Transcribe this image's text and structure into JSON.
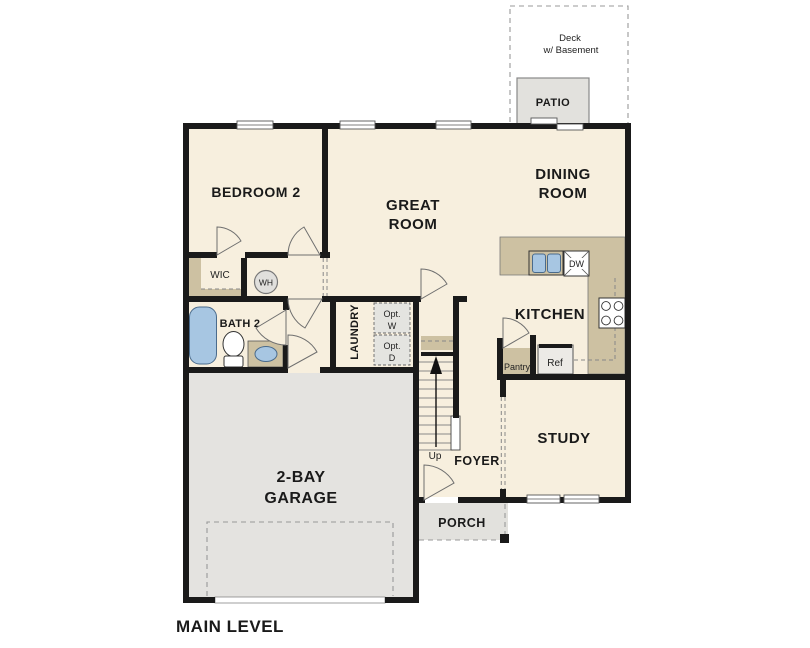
{
  "title": "MAIN LEVEL",
  "colors": {
    "floor_cream": "#f7efde",
    "wall_black": "#1a1a1a",
    "counter_tan": "#cdc1a2",
    "garage_gray": "#e4e3e0",
    "patio_gray": "#e2e1dd",
    "fixture_blue": "#a7c6e2",
    "dash_gray": "#999999"
  },
  "outdoor": {
    "deck": [
      "Deck",
      "w/ Basement"
    ],
    "patio": "PATIO",
    "porch": "PORCH"
  },
  "rooms": {
    "bedroom2": "BEDROOM 2",
    "great_room": [
      "GREAT",
      "ROOM"
    ],
    "dining_room": [
      "DINING",
      "ROOM"
    ],
    "kitchen": "KITCHEN",
    "study": "STUDY",
    "bath2": "BATH 2",
    "wic": "WIC",
    "laundry": "LAUNDRY",
    "foyer": "FOYER",
    "garage": [
      "2-BAY",
      "GARAGE"
    ]
  },
  "fixtures": {
    "water_heater": "WH",
    "dishwasher": "DW",
    "refrigerator": "Ref",
    "pantry": "Pantry",
    "optional_washer": [
      "Opt.",
      "W"
    ],
    "optional_dryer": [
      "Opt.",
      "D"
    ],
    "stairs_up": "Up"
  }
}
